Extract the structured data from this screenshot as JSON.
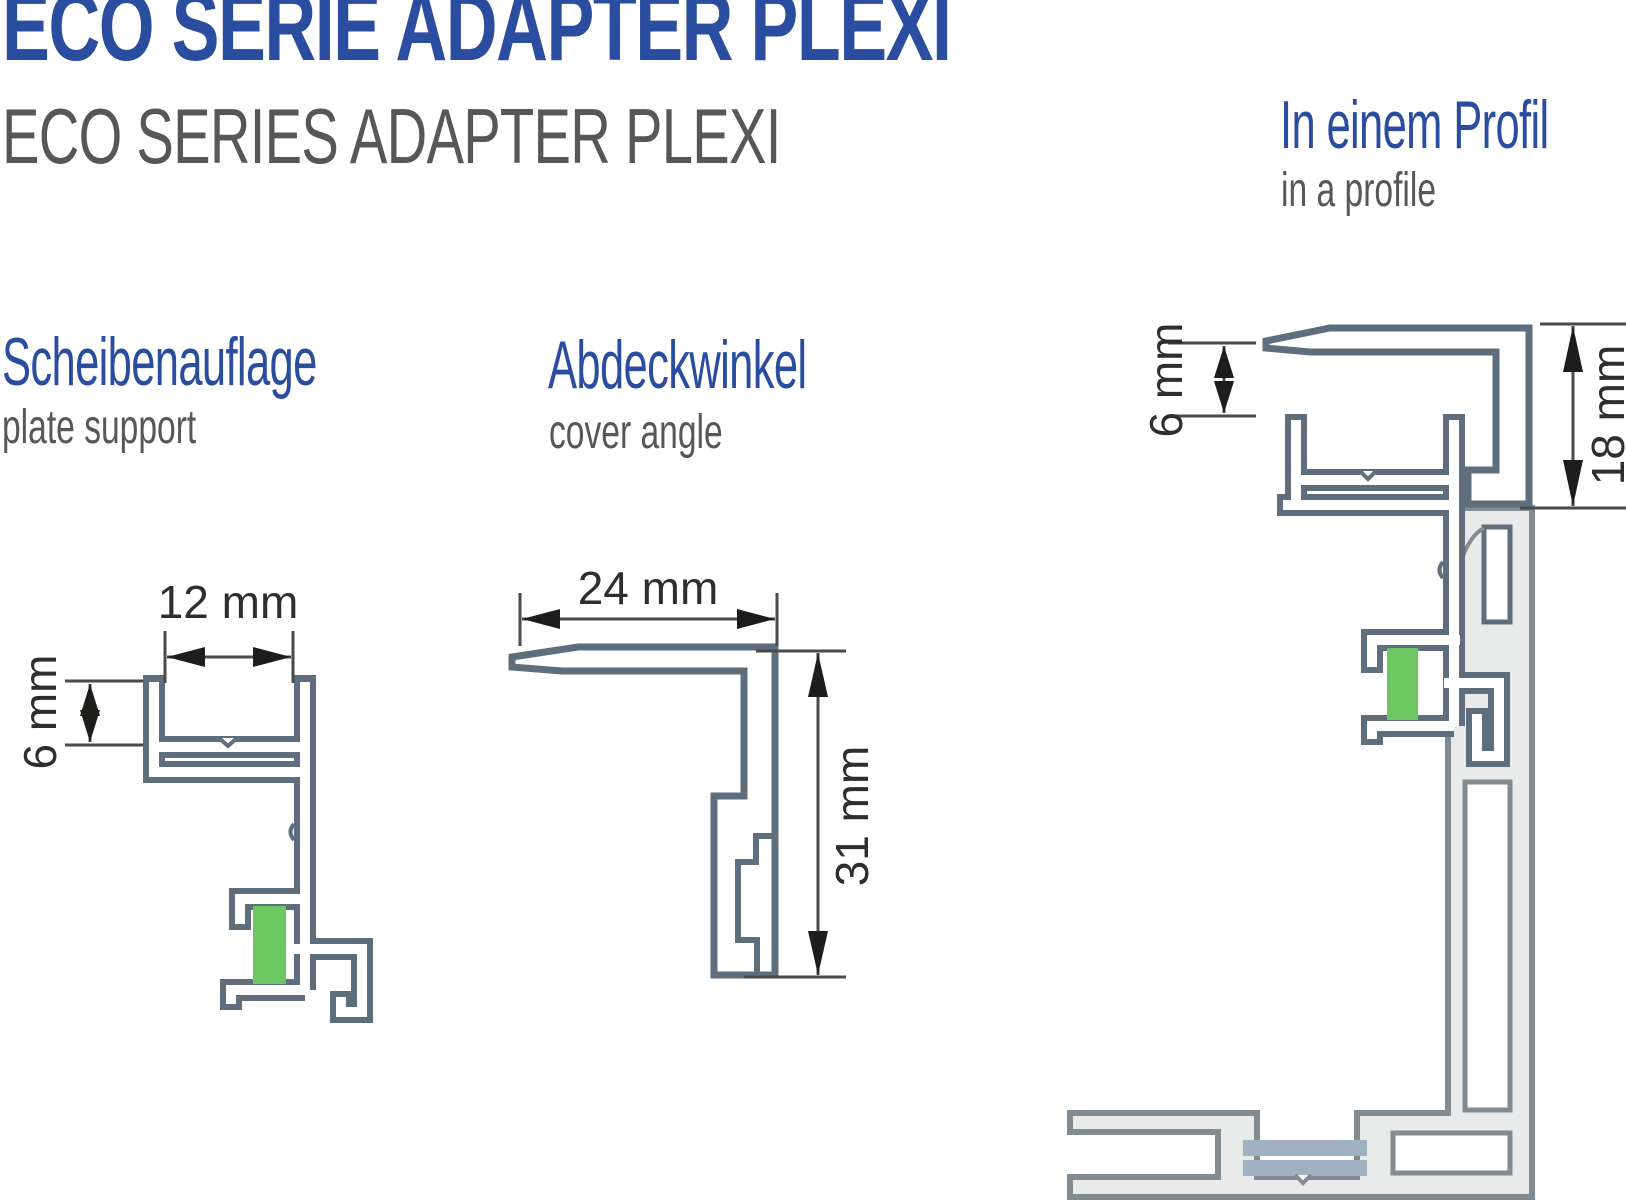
{
  "page": {
    "title": "ECO SERIE ADAPTER PLEXI",
    "subtitle": "ECO SERIES ADAPTER PLEXI"
  },
  "sections": {
    "plate_support": {
      "heading": "Scheibenauflage",
      "subheading": "plate support",
      "dim_width": "12 mm",
      "dim_depth": "6 mm"
    },
    "cover_angle": {
      "heading": "Abdeckwinkel",
      "subheading": "cover angle",
      "dim_width": "24 mm",
      "dim_height": "31 mm"
    },
    "in_profile": {
      "heading": "In einem Profil",
      "subheading": "in a profile",
      "dim_gap": "6 mm",
      "dim_height": "18 mm"
    }
  },
  "colors": {
    "heading_blue": "#2a4da0",
    "text_gray": "#575756",
    "profile_slate": "#5f6e7d",
    "profile_gray_outline": "#828a92",
    "profile_gray_fill": "#e9eaea",
    "plexi_green": "#6cc763",
    "glass_blue": "#a0b2c2",
    "dimension_dark": "#1d1d1b"
  }
}
